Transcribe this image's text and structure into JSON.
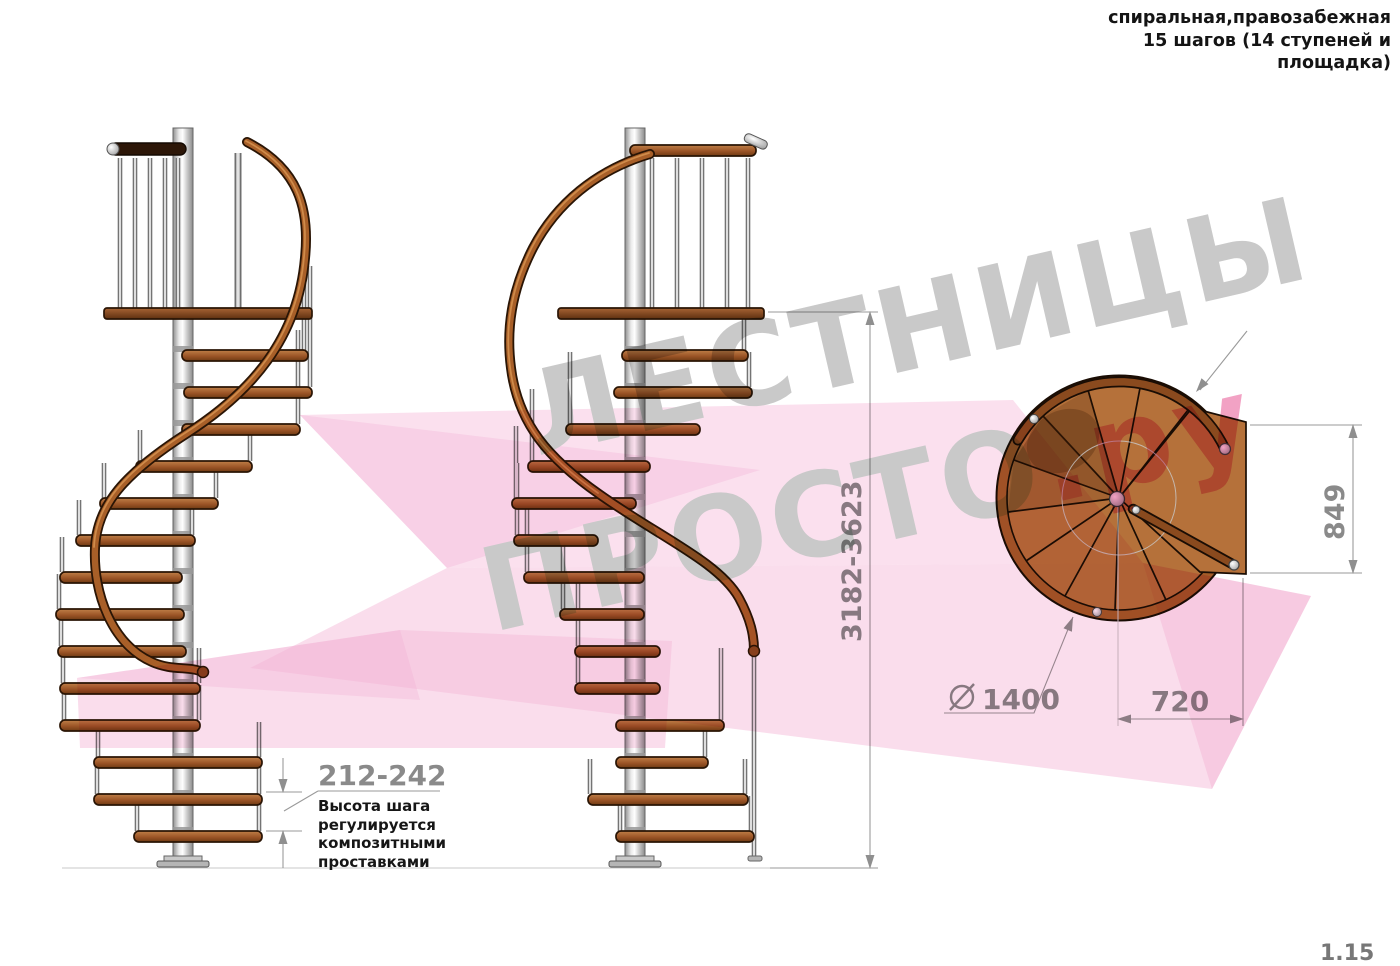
{
  "header": {
    "line1": "спиральная,правозабежная",
    "line2": "15 шагов (14 ступеней и",
    "line3": "площадка)"
  },
  "watermark": {
    "word1": "ЛЕСТНИЦЫ",
    "word2": "ПРОСТО",
    "suffix": ".ру"
  },
  "dimensions": {
    "total_height": "3182-3623",
    "step_height": {
      "value": "212-242",
      "note_lines": [
        "Высота шага",
        "регулируется",
        "композитными",
        "проставками"
      ]
    },
    "platform_depth": "849",
    "platform_width": "720",
    "diameter": {
      "symbol": "⌀",
      "value": "1400"
    }
  },
  "page_number": "1.15",
  "colors": {
    "wood_step": "#9c5527",
    "wood_rail": "#a85f28",
    "pole_silver": "#d9d9d9",
    "dimension_gray": "#8a8a8a",
    "watermark_gray": "#c9c9c9",
    "watermark_pink": "#f2a2c4",
    "ribbon_pink": "#f6bcd9"
  }
}
